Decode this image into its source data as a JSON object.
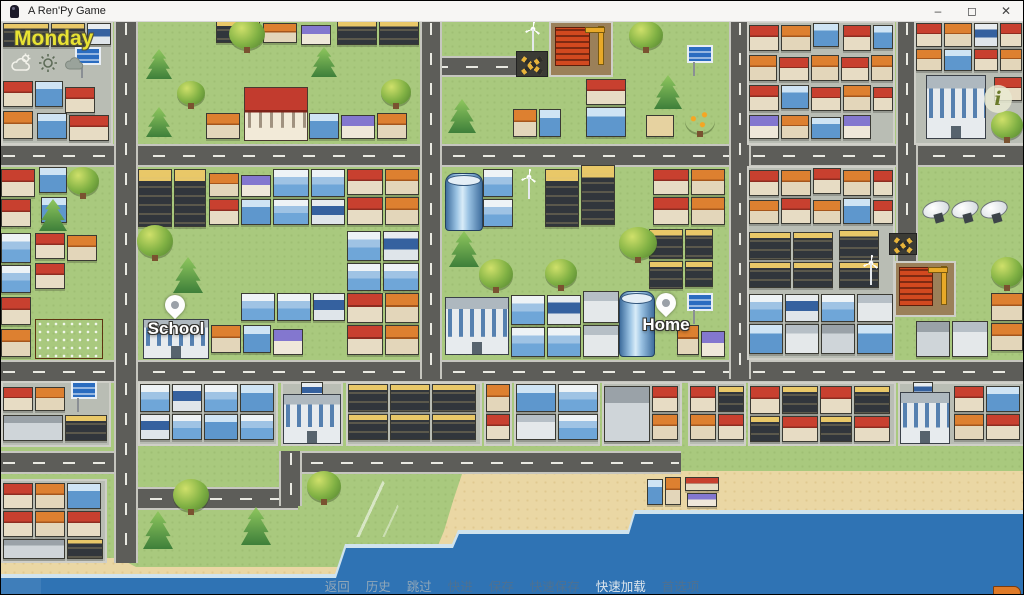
{
  "window": {
    "title": "A Ren'Py Game",
    "controls": {
      "minimize": "–",
      "maximize": "◻",
      "close": "✕"
    }
  },
  "hud": {
    "day": "Monday",
    "weather_icons": [
      {
        "name": "partly-cloudy-icon",
        "state": "active"
      },
      {
        "name": "sunny-icon",
        "state": "dim"
      },
      {
        "name": "cloudy-icon",
        "state": "dim"
      }
    ]
  },
  "map": {
    "pins": [
      {
        "label": "School"
      },
      {
        "label": "Home"
      }
    ],
    "info_icon": "i"
  },
  "quick_menu": {
    "items": [
      {
        "label": "返回",
        "state": "idle"
      },
      {
        "label": "历史",
        "state": "idle"
      },
      {
        "label": "跳过",
        "state": "idle"
      },
      {
        "label": "快进",
        "state": "dim"
      },
      {
        "label": "保存",
        "state": "dim"
      },
      {
        "label": "快速保存",
        "state": "dim"
      },
      {
        "label": "快速加载",
        "state": "highlight"
      },
      {
        "label": "首选项",
        "state": "dim"
      }
    ]
  },
  "colors": {
    "day_accent": "#e8e233",
    "grass": "#a9c97e",
    "road": "#5d5d59",
    "sea": "#2f73b4",
    "sand": "#ead7a4",
    "titlebar": "#f7f6f4",
    "menu_idle": "#8fa6b8",
    "menu_dim": "#4e7191",
    "menu_highlight": "#dde6ed"
  }
}
